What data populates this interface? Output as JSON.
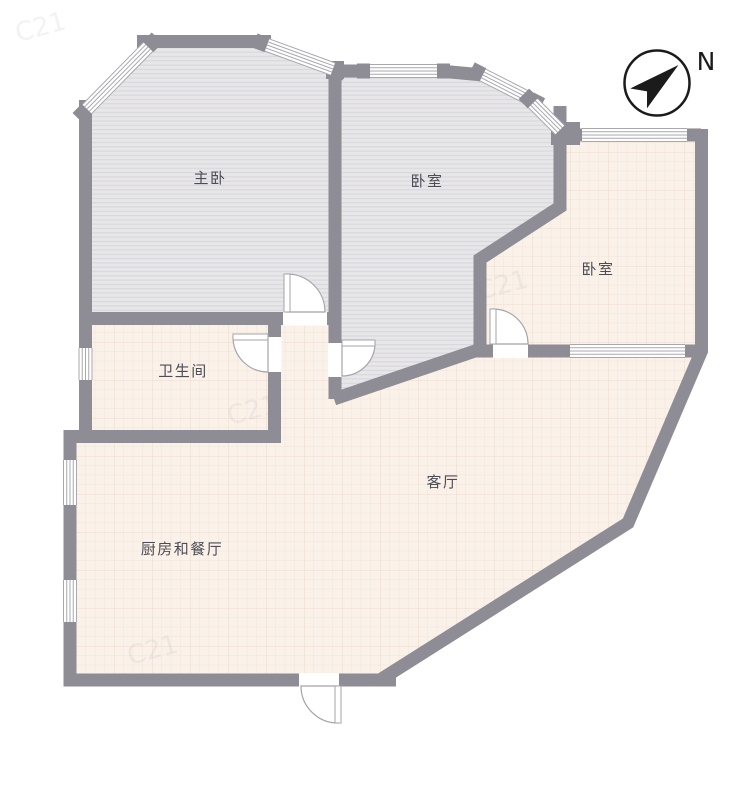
{
  "compass": {
    "label": "N"
  },
  "rooms": [
    {
      "id": "master-bedroom",
      "label": "主卧"
    },
    {
      "id": "bedroom-north",
      "label": "卧室"
    },
    {
      "id": "bedroom-east",
      "label": "卧室"
    },
    {
      "id": "bathroom",
      "label": "卫生间"
    },
    {
      "id": "living-room",
      "label": "客厅"
    },
    {
      "id": "kitchen-dining",
      "label": "厨房和餐厅"
    }
  ],
  "watermark": {
    "text": "C21"
  },
  "colors": {
    "wall": "#8e8c94",
    "floor_gray": "#e7e6e9",
    "floor_gray_stripe": "#d8d7db",
    "floor_pink": "#faf1e9",
    "floor_pink_grid": "#eddccf",
    "door_line": "#a5a3ab",
    "compass_ink": "#1b1b1b"
  }
}
